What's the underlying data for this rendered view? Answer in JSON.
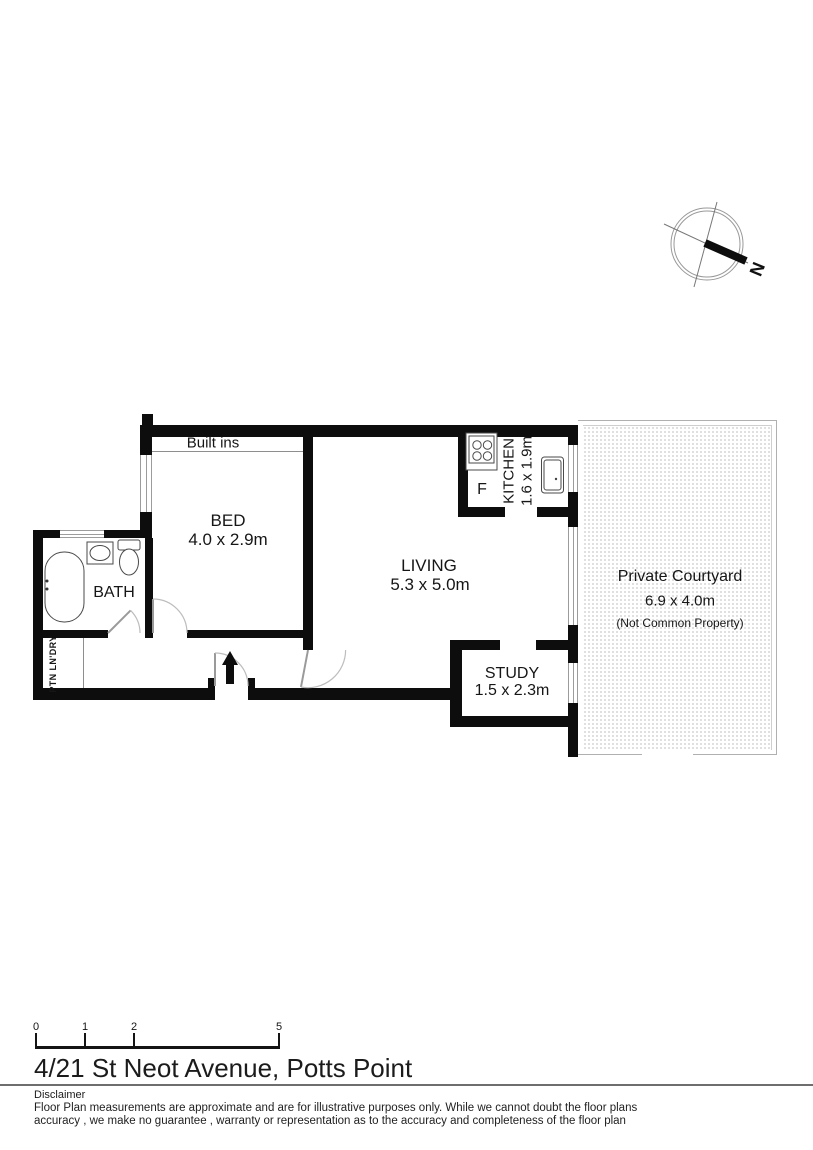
{
  "meta": {
    "title": "4/21 St Neot Avenue, Potts Point"
  },
  "compass": {
    "north": "N"
  },
  "plan": {
    "built_ins": "Built ins",
    "bed": {
      "name": "BED",
      "dims": "4.0 x 2.9m"
    },
    "bath": {
      "name": "BATH"
    },
    "laundry": {
      "name": "PTN LN'DRY"
    },
    "living": {
      "name": "LIVING",
      "dims": "5.3 x 5.0m"
    },
    "kitchen": {
      "name": "KITCHEN",
      "dims": "1.6 x 1.9m",
      "fridge": "F"
    },
    "study": {
      "name": "STUDY",
      "dims": "1.5 x 2.3m"
    },
    "courtyard": {
      "name": "Private Courtyard",
      "dims": "6.9 x 4.0m",
      "note": "(Not Common Property)"
    }
  },
  "scale_bar": {
    "ticks": [
      "0",
      "1",
      "2",
      "5"
    ]
  },
  "footer": {
    "disclaimer_heading": "Disclaimer",
    "disclaimer_line1": "Floor Plan measurements are approximate and are for illustrative purposes only. While we cannot doubt the floor plans",
    "disclaimer_line2": "accuracy , we make no guarantee , warranty or representation as to the accuracy and completeness of the floor plan"
  },
  "colors": {
    "wall": "#0d0d0d",
    "thin_line": "#9c9c9c",
    "text": "#161616"
  }
}
